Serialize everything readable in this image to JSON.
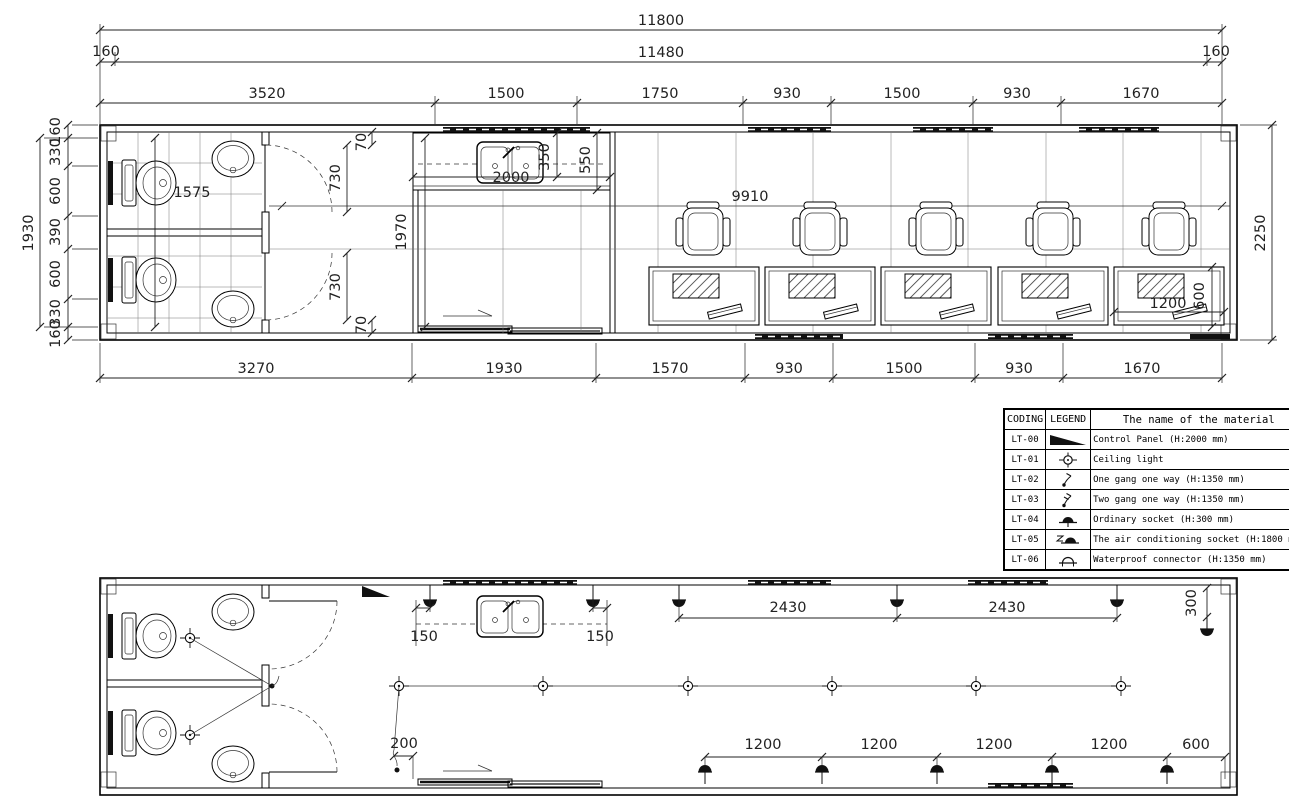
{
  "dims": {
    "t11800": "11800",
    "t160a": "160",
    "t11480": "11480",
    "t160b": "160",
    "tc": [
      "3520",
      "1500",
      "1750",
      "930",
      "1500",
      "930",
      "1670"
    ],
    "bc": [
      "3270",
      "1930",
      "1570",
      "930",
      "1500",
      "930",
      "1670"
    ],
    "lc": [
      "160",
      "330",
      "600",
      "390",
      "600",
      "330",
      "160"
    ],
    "l1930": "1930",
    "r2250": "2250",
    "i1575": "1575",
    "i730a": "730",
    "i730b": "730",
    "i70a": "70",
    "i70b": "70",
    "i1970": "1970",
    "i2000": "2000",
    "i350": "350",
    "i550": "550",
    "i9910": "9910",
    "i1200": "1200",
    "i600": "600"
  },
  "edims": {
    "e150a": "150",
    "e150b": "150",
    "e2430a": "2430",
    "e2430b": "2430",
    "e300": "300",
    "e200": "200",
    "sc": [
      "1200",
      "1200",
      "1200",
      "1200",
      "600"
    ]
  },
  "legend": {
    "headers": [
      "CODING",
      "LEGEND",
      "The name of the material"
    ],
    "rows": [
      {
        "code": "LT-00",
        "icon": "control-panel",
        "name": "Control Panel (H:2000 mm)"
      },
      {
        "code": "LT-01",
        "icon": "ceiling-light",
        "name": "Ceiling light"
      },
      {
        "code": "LT-02",
        "icon": "one-gang-switch",
        "name": "One gang one way (H:1350 mm)"
      },
      {
        "code": "LT-03",
        "icon": "two-gang-switch",
        "name": "Two gang one way (H:1350 mm)"
      },
      {
        "code": "LT-04",
        "icon": "ordinary-socket",
        "name": "Ordinary socket (H:300 mm)"
      },
      {
        "code": "LT-05",
        "icon": "ac-socket",
        "name": "The air conditioning socket (H:1800 mm)"
      },
      {
        "code": "LT-06",
        "icon": "waterproof-connector",
        "name": "Waterproof connector (H:1350 mm)"
      }
    ]
  }
}
